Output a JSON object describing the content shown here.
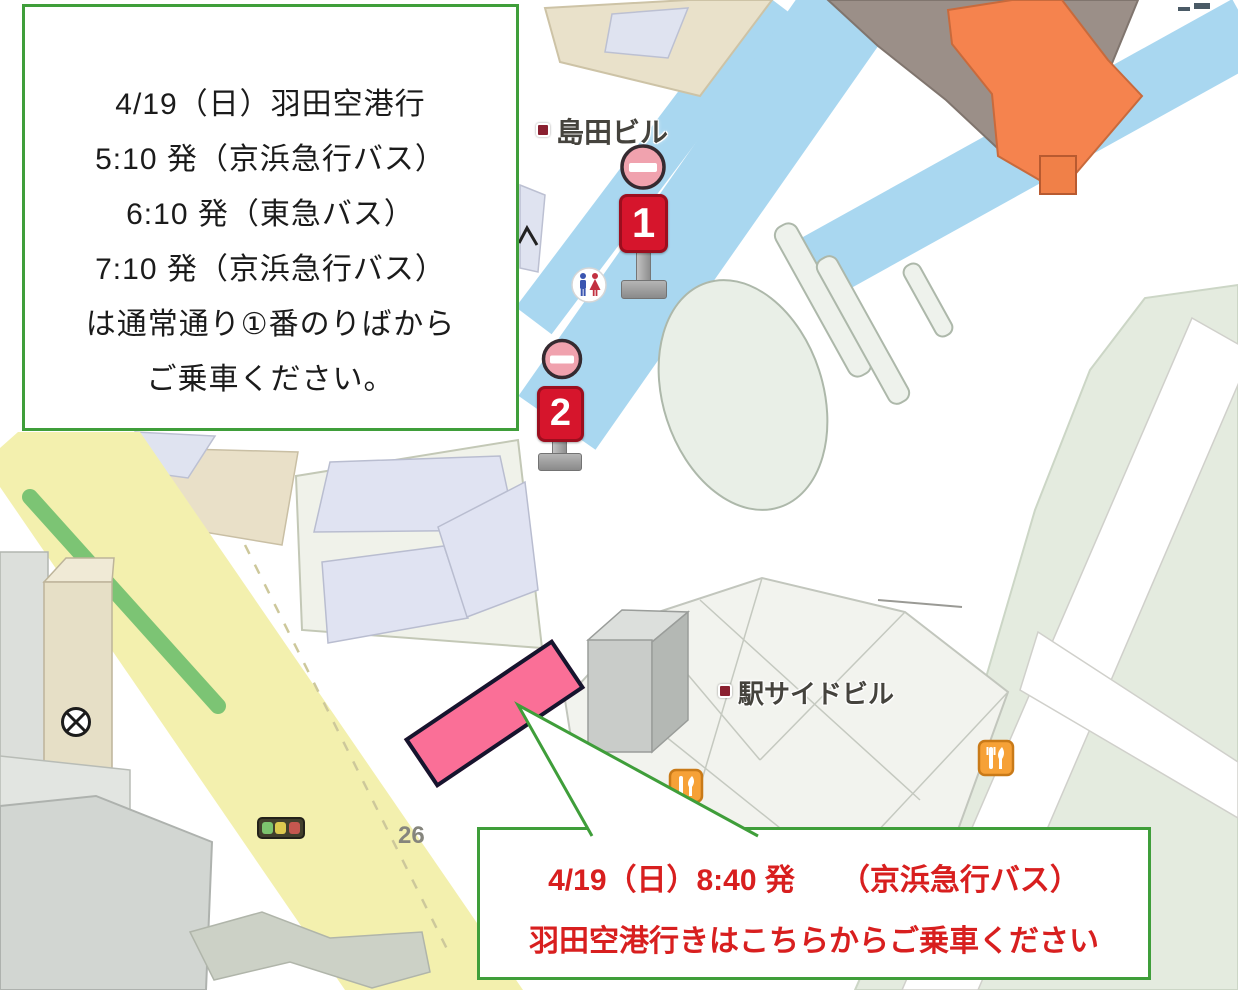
{
  "notice_top": {
    "lines": [
      "4/19（日）羽田空港行",
      "5:10 発（京浜急行バス）",
      "6:10 発（東急バス）",
      "7:10 発（京浜急行バス）",
      "は通常通り①番のりばから",
      "ご乗車ください。"
    ],
    "border_color": "#3f9e3a",
    "text_color": "#1b1b1b"
  },
  "notice_bottom": {
    "lines": [
      "4/19（日）8:40 発　　（京浜急行バス）",
      "羽田空港行きはこちらからご乗車ください"
    ],
    "border_color": "#3f9e3a",
    "text_color": "#d81f1f"
  },
  "map": {
    "building_labels": [
      {
        "text": "島田ビル"
      },
      {
        "text": "駅サイドビル"
      }
    ],
    "bus_stops": [
      {
        "number": "1"
      },
      {
        "number": "2"
      }
    ],
    "road_number": "26",
    "icons": [
      "no-entry-icon",
      "restroom-icon",
      "restaurant-icon",
      "traffic-light-icon",
      "barrier-icon"
    ],
    "colors": {
      "deck_road_blue": "#a9d7f0",
      "road_yellow": "#f3f0ae",
      "greenbelt_green": "#7cc474",
      "highlight_pink": "#fa6f97",
      "bus_stop_red": "#d6152c",
      "notice_border_green": "#3f9e3a",
      "notice_text_red": "#d81f1f",
      "station_orange": "#f5834e"
    }
  }
}
